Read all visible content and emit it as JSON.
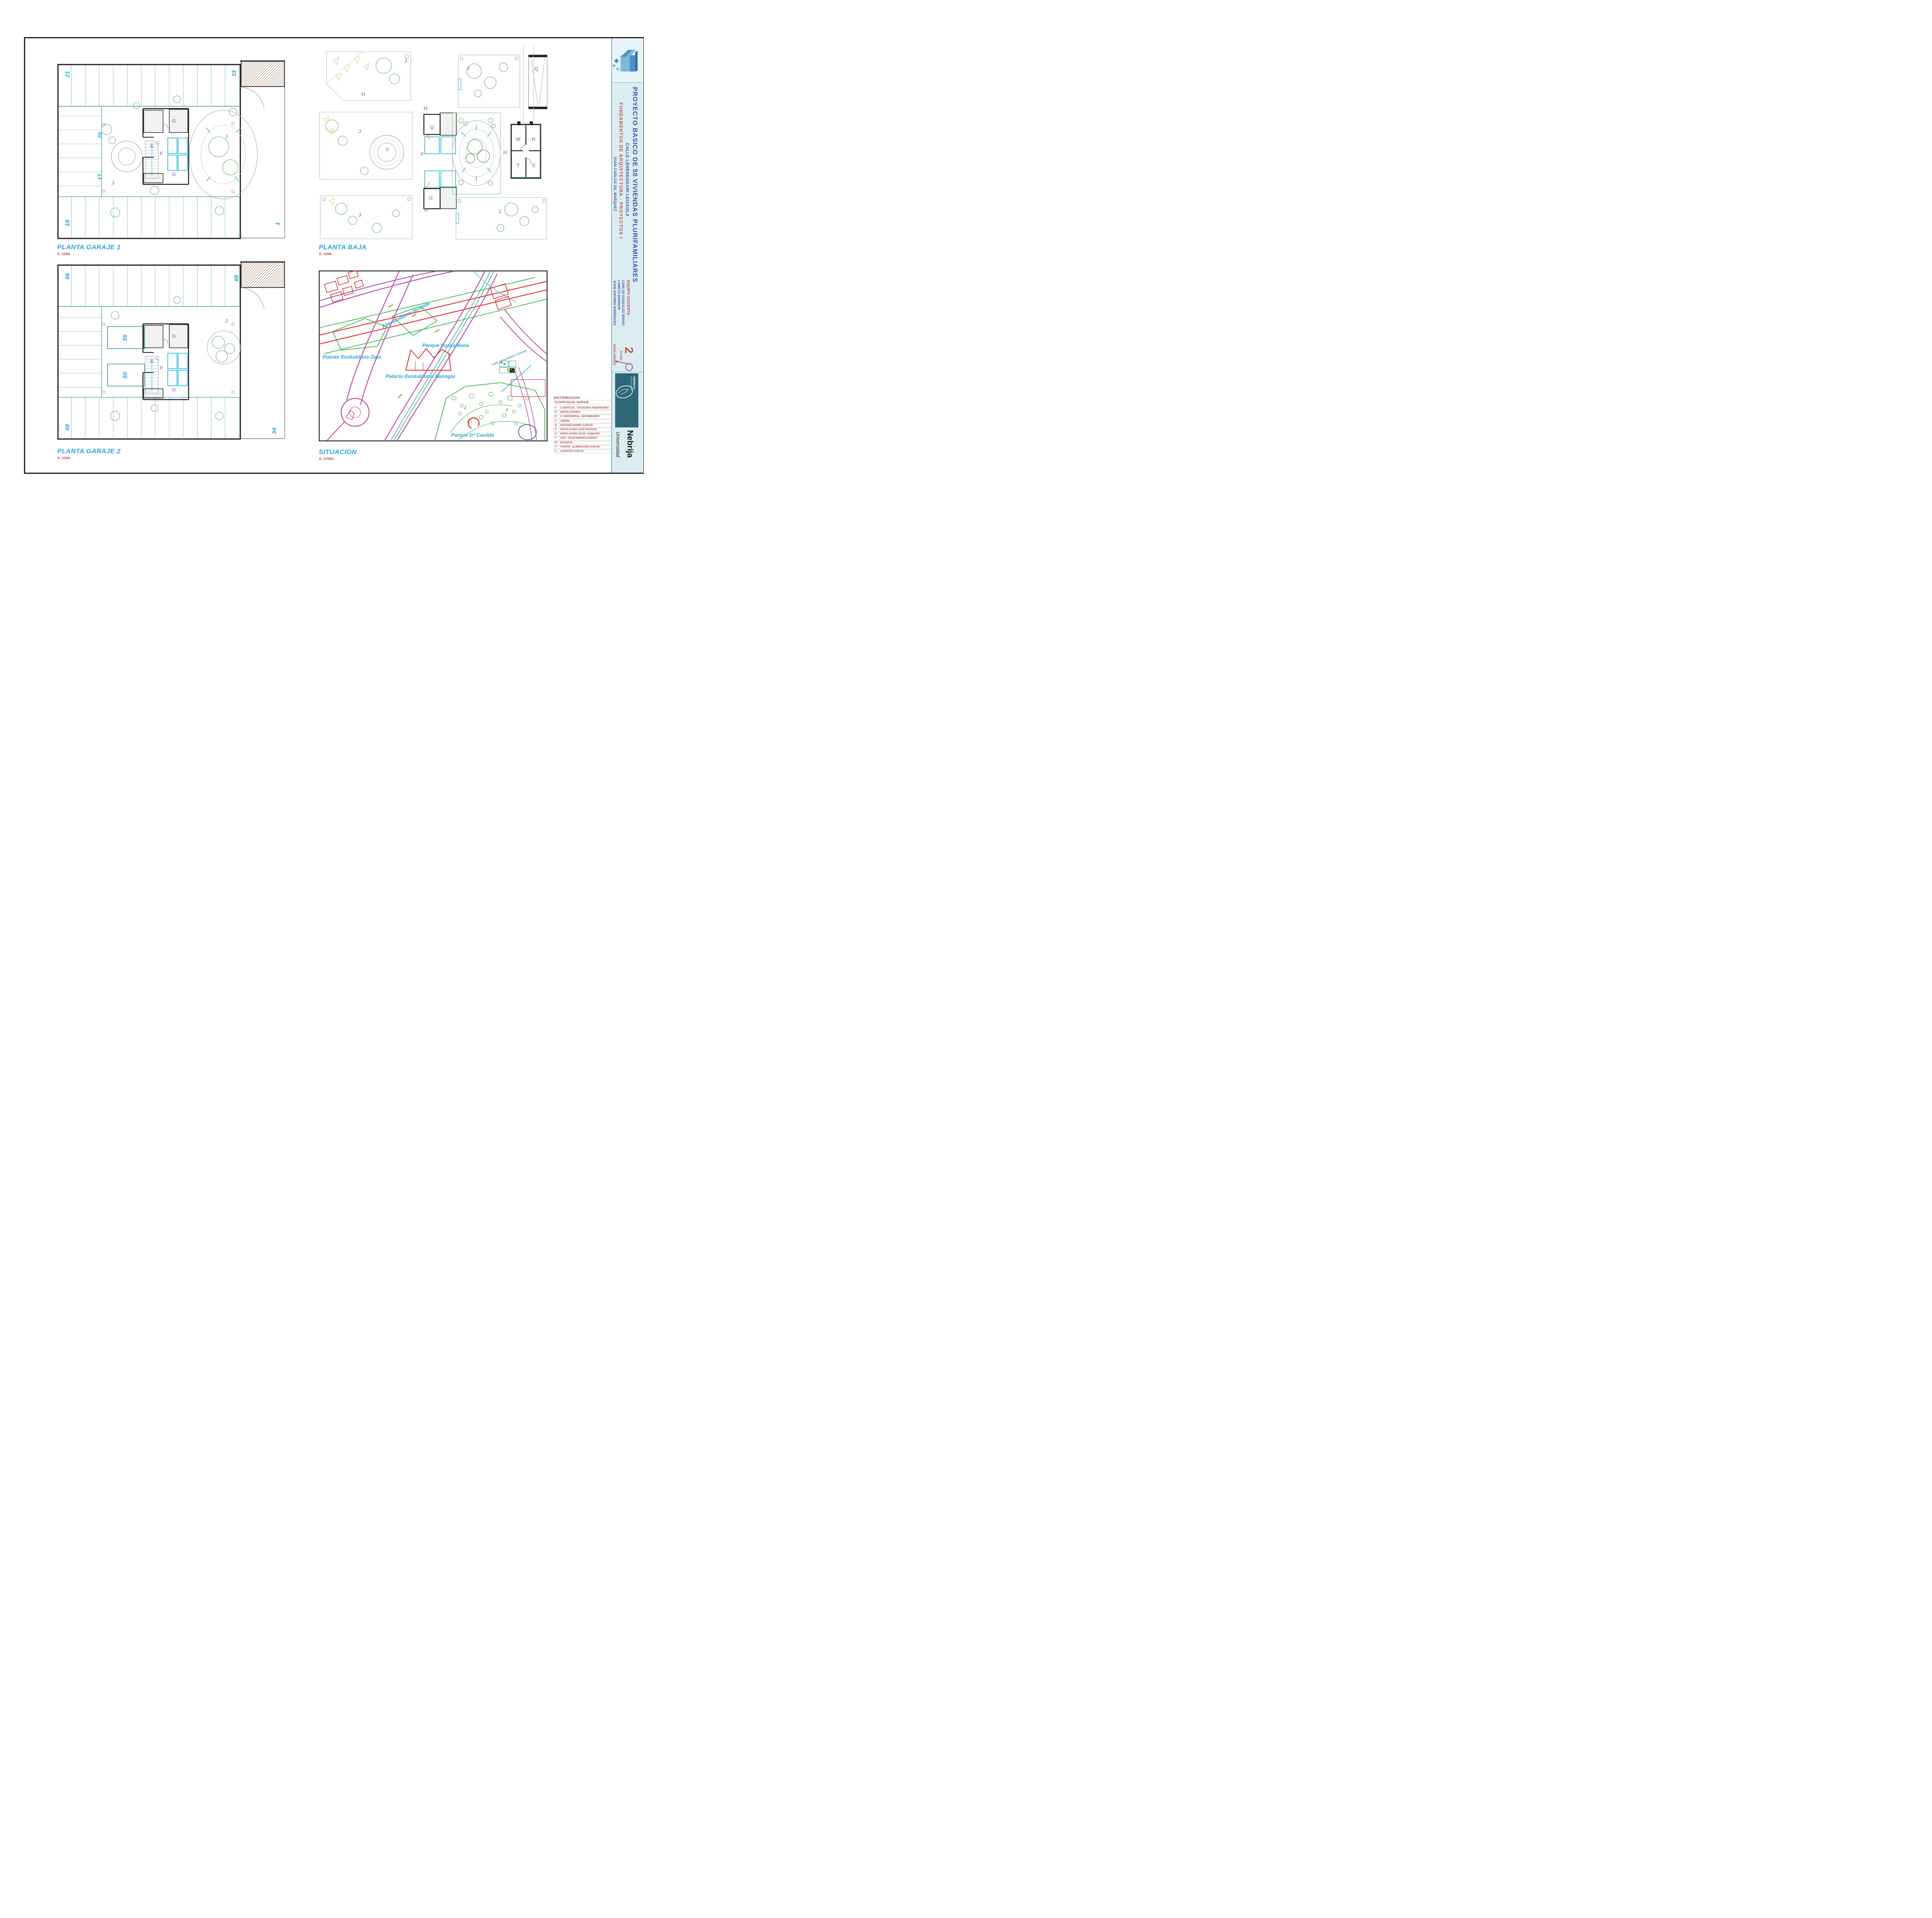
{
  "plans": {
    "garaje1": {
      "title": "PLANTA GARAJE 1",
      "scale": "E: 1/200",
      "numbers": {
        "n21": "21",
        "n33": "33",
        "n20": "20",
        "n17": "17",
        "n16": "16",
        "n1": "1"
      },
      "letters": {
        "g_top": "G",
        "z": "Z",
        "f": "F",
        "g_bottom": "G",
        "j_left": "J",
        "j_right": "J"
      }
    },
    "baja": {
      "title": "PLANTA BAJA",
      "scale": "E: 1/200",
      "letters": {
        "h_pav_a": "H",
        "j_pav_a": "J",
        "j_pav_b": "J",
        "q_ramp": "Q",
        "h_core_top": "H",
        "g_core_top": "G",
        "f_core": "F",
        "g_core_bottom": "G",
        "h_core_bottom": "H",
        "j_pav_c": "J",
        "y_fountain": "Y",
        "h_right": "H",
        "w": "W",
        "r": "R",
        "t": "T",
        "s": "S",
        "j_pav_d": "J",
        "j_pav_e": "J"
      }
    },
    "garaje2": {
      "title": "PLANTA GARAJE 2",
      "scale": "E: 1/200",
      "numbers": {
        "n56": "56",
        "n68": "68",
        "n55": "55",
        "n50": "50",
        "n49": "49",
        "n34": "34"
      },
      "letters": {
        "g_top": "G",
        "z": "Z",
        "f": "F",
        "g_bottom": "G",
        "j_right": "J"
      }
    },
    "situacion": {
      "title": "SITUACION",
      "scale": "E: 1/7000",
      "map_labels": {
        "abandoibarra": "Abandoibarra Hiribide",
        "puente": "Puente Euskalduna Zubi",
        "parque_euskalduna": "Parque Euskalduna",
        "palacio": "Palacio Euskalduna Jauregia",
        "parque_casilda": "Parque Dª Casilda",
        "calle": "Calle Lehendakari Leizaola",
        "paseo": "Paseo Eduardo Victoria de Lecea"
      },
      "letters": {
        "j1": "J",
        "j2": "J",
        "j3": "J"
      }
    }
  },
  "legend": {
    "title": "DISTRIBUCION",
    "subtitle": "PLANTA BAJA- GARAJE",
    "rows": [
      {
        "key": "F",
        "label": "C.VERTICAL - ESCALERA-ASCENSORES"
      },
      {
        "key": "G",
        "label": "INSTALACIONES"
      },
      {
        "key": "H",
        "label": "C. HORIZONTAL - DISTRIBUIDOR"
      },
      {
        "key": "J",
        "label": "JARDIN"
      },
      {
        "key": "Q",
        "label": "ENTRADA-RAMPA GARAJE"
      },
      {
        "key": "R",
        "label": "INSTALACION- ELECTRICIDAD"
      },
      {
        "key": "S",
        "label": "ISNTALACION- AGUA- ALMACEN"
      },
      {
        "key": "T",
        "label": "ISNT.- TELECOMUNICACIONES"
      },
      {
        "key": "W",
        "label": "BASURAS"
      },
      {
        "key": "Y",
        "label": "FUENTE - ILUMINACIÓN GARAJE"
      },
      {
        "key": "Z",
        "label": "ALMACEN GARAJE"
      }
    ]
  },
  "title_block": {
    "project": "PROYECTO BASICO DE 50 VIVIENDAS PLURIFAMILIARES",
    "address": "CALLE LEHENDAKARI LEIZAOLA",
    "course": "FUNDAMENTOS DE ARQUITECTURA - PROYECTOS I",
    "author": "JUAN CARLOS GIL MARQUEZ",
    "team_heading": "EQUIPO DOCENTE",
    "team": [
      "CARLOS GONZALEZ BRAVO",
      "LORETO BARRIOS",
      "JUAN ANTONIO RODRIGUEZ"
    ],
    "date": "FECHA: 27/01/2012",
    "sheet_number": "2",
    "sheet_label": "PLANO",
    "university_logo_line1": "UNIVERSIDAD",
    "university_logo_line2": "NEBRIJA",
    "university_name": "Nebrija",
    "university_sub": "Universidad"
  },
  "colors": {
    "accent_cyan": "#29abe2",
    "accent_red": "#b5413c",
    "title_blue": "#3d55a5",
    "title_red": "#bf4f4a",
    "zone_magenta": "#bb7fd0",
    "stall_teal": "#2a9d97",
    "map_magenta": "#c355b4",
    "map_green": "#3cb54a",
    "map_red": "#e8262b"
  }
}
